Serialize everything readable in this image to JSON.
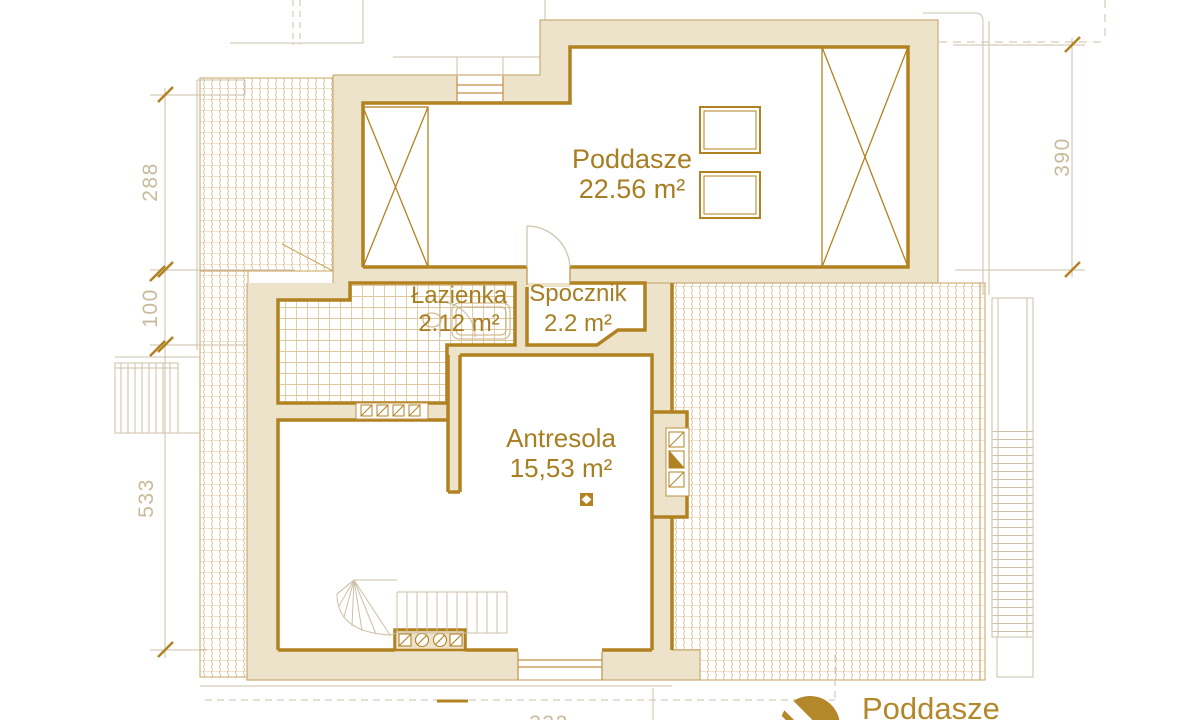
{
  "rooms": [
    {
      "name": "Poddasze",
      "area": "22.56 m²"
    },
    {
      "name": "Łazienka",
      "area": "2.12 m²"
    },
    {
      "name": "Spocznik",
      "area": "2.2 m²"
    },
    {
      "name": "Antresola",
      "area": "15,53 m²"
    }
  ],
  "dimensions": {
    "left": [
      "288",
      "100",
      "533"
    ],
    "right": [
      "390"
    ],
    "bottom": [
      "332"
    ]
  },
  "logo": {
    "label": "Poddasze"
  },
  "colors": {
    "wall_fill": "#EDE2CA",
    "wall_line": "#B28221",
    "thin_wall_line": "#C19045",
    "label_text": "#A87E22",
    "light_lines": "#CDC1A8",
    "dim_text": "#C9BA99",
    "roof_tile_hatch": "#C8A15C",
    "bath_tile_grid": "#C49A4E",
    "logo_gold": "#B3882A"
  }
}
